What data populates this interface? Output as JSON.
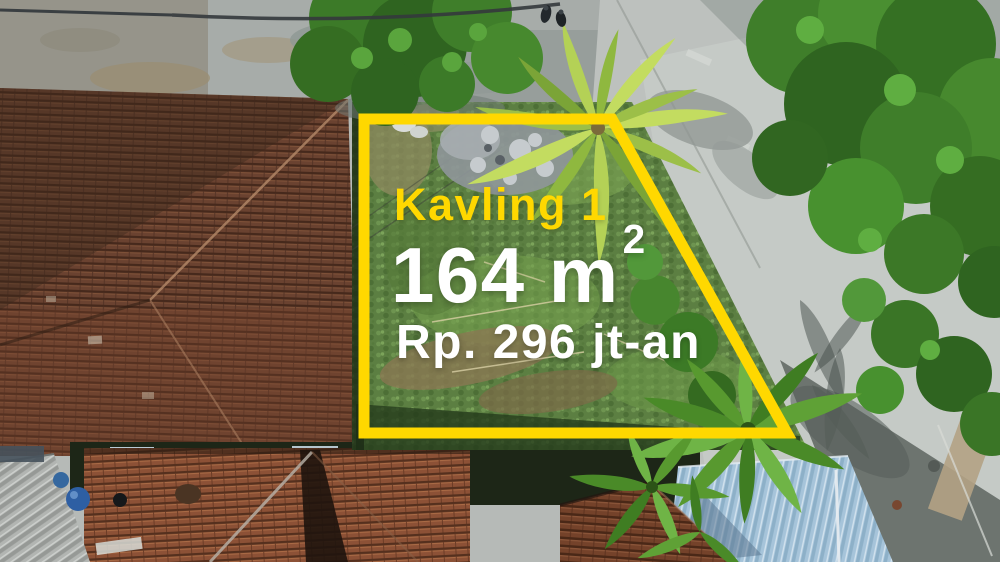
{
  "overlay": {
    "plot_label": "Kavling 1",
    "area_value": "164 m",
    "area_superscript": "2",
    "price": "Rp. 296 jt-an"
  },
  "colors": {
    "boundary_yellow": "#FFD800",
    "label_yellow": "#FFD800",
    "value_white": "#FFFFFF",
    "grass_green": "#5C7F42",
    "roof_terracotta": "#6A4230",
    "road_gray": "#BDC1BE",
    "tree_green": "#3F7E2A",
    "metal_roof_blue": "#A6C4DA"
  },
  "scene": {
    "elements": [
      "terracotta-roof-houses",
      "grass-land-plot",
      "rubble-pile",
      "coconut-palm",
      "banana-plants",
      "concrete-road",
      "green-trees",
      "blue-metal-roof",
      "gray-corrugated-roof",
      "water-barrels",
      "pedestrians",
      "plot-boundary"
    ]
  }
}
